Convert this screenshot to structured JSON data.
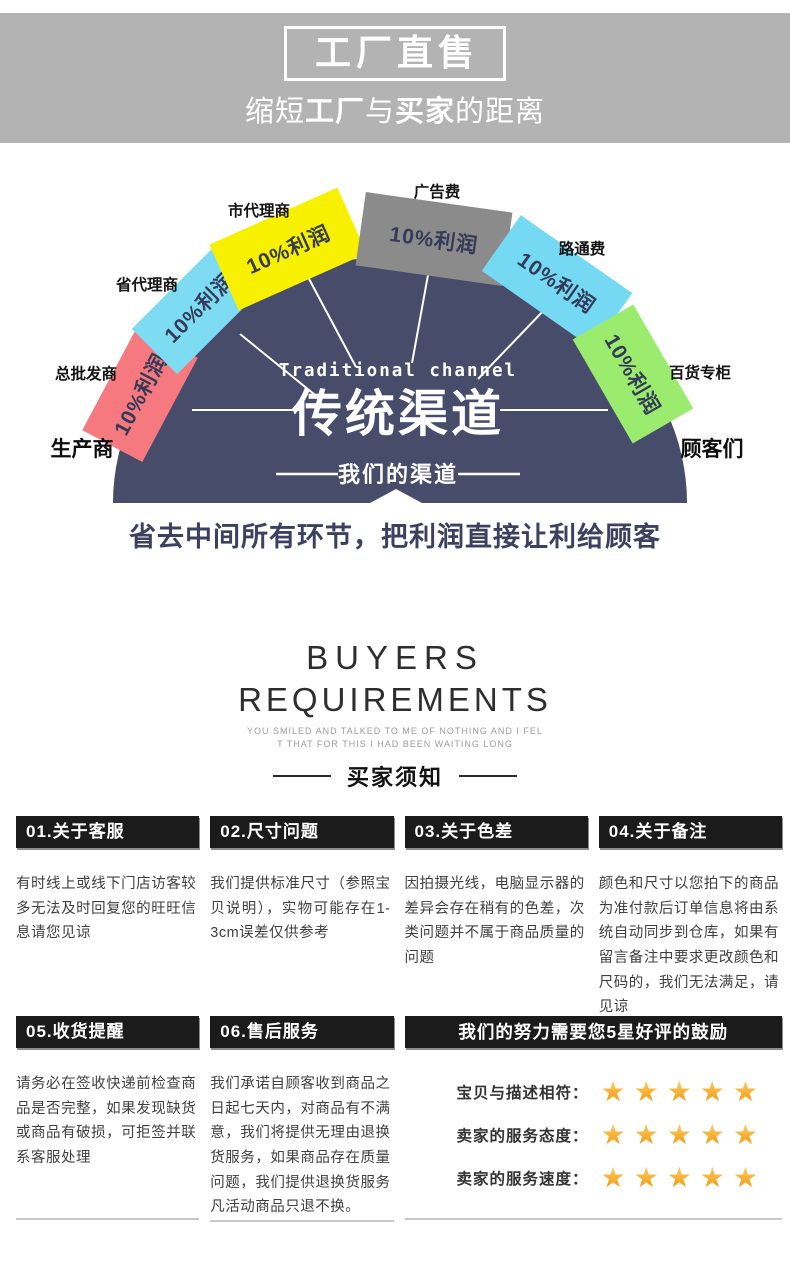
{
  "banner": {
    "title": "工厂直售",
    "subtitle_pre": "缩短",
    "subtitle_bold1": "工厂",
    "subtitle_mid": "与",
    "subtitle_bold2": "买家",
    "subtitle_post": "的距离"
  },
  "diagram": {
    "title_en": "Traditional channel",
    "title_cn": "传统渠道",
    "our_channel": "我们的渠道",
    "slogan": "省去中间所有环节，把利润直接让利给顾客",
    "producer": "生产商",
    "customers": "顾客们",
    "circle_color": "#474c6b",
    "segments": [
      {
        "label": "总批发商",
        "profit": "10%利润",
        "color": "#f5797f"
      },
      {
        "label": "省代理商",
        "profit": "10%利润",
        "color": "#7edcf2"
      },
      {
        "label": "市代理商",
        "profit": "10%利润",
        "color": "#f7f000"
      },
      {
        "label": "广告费",
        "profit": "10%利润",
        "color": "#8b8b8b"
      },
      {
        "label": "路通费",
        "profit": "10%利润",
        "color": "#76d9f3"
      },
      {
        "label": "百货专柜",
        "profit": "10%利润",
        "color": "#9bec6e"
      }
    ]
  },
  "buyers": {
    "title_line1": "BUYERS",
    "title_line2": "REQUIREMENTS",
    "note_line1": "YOU SMILED AND TALKED TO ME OF NOTHING AND I FEL",
    "note_line2": "T THAT FOR THIS I HAD BEEN WAITING LONG",
    "cn_title": "买家须知"
  },
  "notices": [
    {
      "title": "01.关于客服",
      "body": "有时线上或线下门店访客较多无法及时回复您的旺旺信息请您见谅"
    },
    {
      "title": "02.尺寸问题",
      "body": "我们提供标准尺寸（参照宝贝说明），实物可能存在1-3cm误差仅供参考"
    },
    {
      "title": "03.关于色差",
      "body": "因拍摄光线，电脑显示器的差异会存在稍有的色差，次类问题并不属于商品质量的问题"
    },
    {
      "title": "04.关于备注",
      "body": "颜色和尺寸以您拍下的商品为准付款后订单信息将由系统自动同步到仓库，如果有留言备注中要求更改颜色和尺码的，我们无法满足，请见谅"
    },
    {
      "title": "05.收货提醒",
      "body": "请务必在签收快递前检查商品是否完整，如果发现缺货或商品有破损，可拒签并联系客服处理"
    },
    {
      "title": "06.售后服务",
      "body": "我们承诺自顾客收到商品之日起七天内，对商品有不满意，我们将提供无理由退换货服务，如果商品存在质量问题，我们提供退换货服务凡活动商品只退不换。"
    }
  ],
  "ratings": {
    "header": "我们的努力需要您5星好评的鼓励",
    "star_icon": "★",
    "star_count": 5,
    "gold_color": "#f7a81f",
    "rows": [
      {
        "label": "宝贝与描述相符："
      },
      {
        "label": "卖家的服务态度："
      },
      {
        "label": "卖家的服务速度："
      }
    ]
  }
}
